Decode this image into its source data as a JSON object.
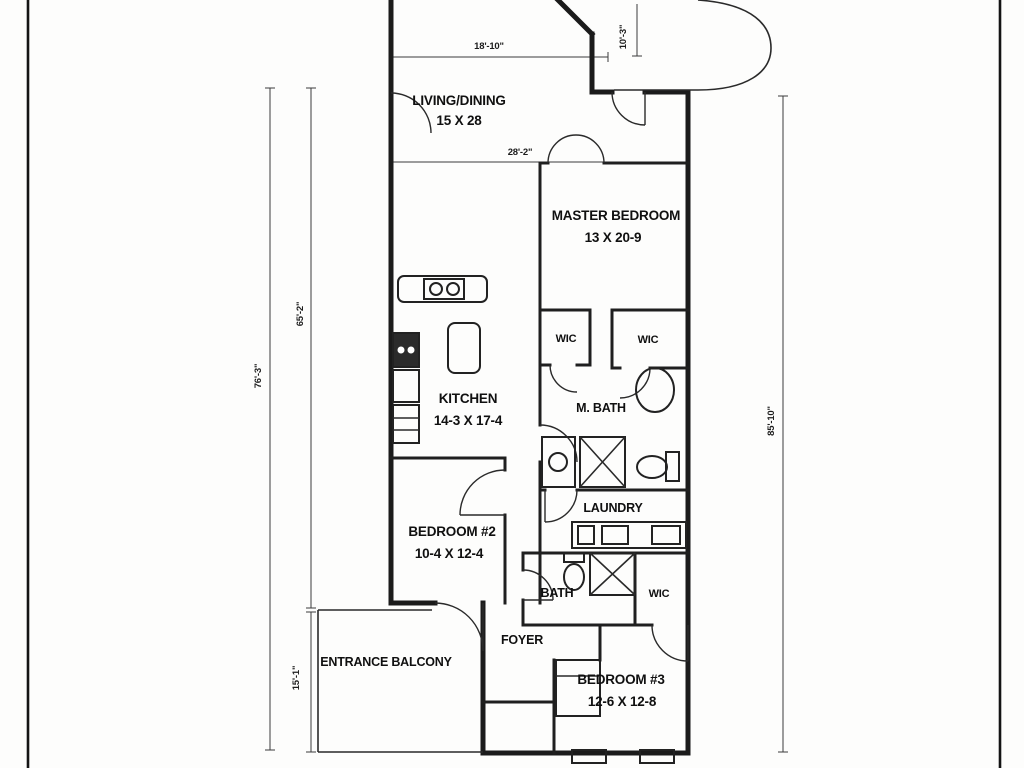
{
  "plan": {
    "rooms": [
      {
        "name": "living-dining",
        "label": "LIVING/DINING",
        "dims": "15 X 28"
      },
      {
        "name": "master-bedroom",
        "label": "MASTER BEDROOM",
        "dims": "13 X 20-9"
      },
      {
        "name": "kitchen",
        "label": "KITCHEN",
        "dims": "14-3 X 17-4"
      },
      {
        "name": "master-bath",
        "label": "M. BATH",
        "dims": ""
      },
      {
        "name": "wic-master-left",
        "label": "WIC",
        "dims": ""
      },
      {
        "name": "wic-master-right",
        "label": "WIC",
        "dims": ""
      },
      {
        "name": "bedroom-2",
        "label": "BEDROOM #2",
        "dims": "10-4 X 12-4"
      },
      {
        "name": "laundry",
        "label": "LAUNDRY",
        "dims": ""
      },
      {
        "name": "bath-2",
        "label": "BATH",
        "dims": ""
      },
      {
        "name": "wic-bedroom-3",
        "label": "WIC",
        "dims": ""
      },
      {
        "name": "foyer",
        "label": "FOYER",
        "dims": ""
      },
      {
        "name": "entrance-balcony",
        "label": "ENTRANCE BALCONY",
        "dims": ""
      },
      {
        "name": "bedroom-3",
        "label": "BEDROOM #3",
        "dims": "12-6 X 12-8"
      }
    ],
    "dimensions": [
      {
        "name": "top-width",
        "label": "18'-10\""
      },
      {
        "name": "living-dining-width",
        "label": "28'-2\""
      },
      {
        "name": "top-balcony-depth",
        "label": "10'-3\""
      },
      {
        "name": "left-inner-height",
        "label": "65'-2\""
      },
      {
        "name": "left-outer-height",
        "label": "76'-3\""
      },
      {
        "name": "right-height",
        "label": "85'-10\""
      },
      {
        "name": "balcony-height",
        "label": "15'-1\""
      }
    ],
    "colors": {
      "ink": "#1b1b1b",
      "background": "#fdfdfc"
    }
  }
}
